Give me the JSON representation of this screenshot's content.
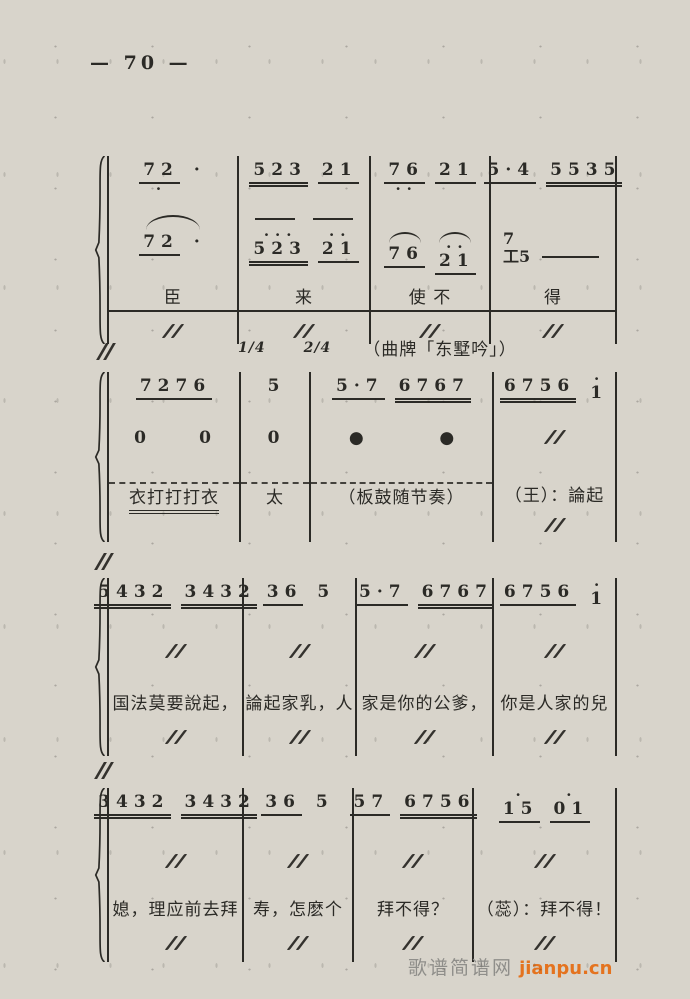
{
  "page": {
    "number": "— 70 —"
  },
  "watermark": {
    "site": "歌谱简谱网",
    "url": "jianpu.cn",
    "url_color": "#e4731f"
  },
  "score": {
    "header": {
      "time_sig_a": "1/4",
      "time_sig_b": "2/4",
      "qupai": "（曲牌「东墅吟」）"
    },
    "systems": [
      {
        "id": 1,
        "top": 156,
        "widths": [
          130,
          132,
          120,
          126
        ],
        "rows": [
          "v1",
          "mid",
          "v2",
          "lyr",
          "sim"
        ],
        "row_heights": [
          56,
          16,
          56,
          34,
          26
        ],
        "measures": [
          {
            "v1": [
              {
                "t": "72",
                "u": 1,
                "db": "·"
              },
              {
                "t": "·"
              }
            ],
            "mid": "arc",
            "v2": [
              {
                "t": "72",
                "u": 1
              },
              {
                "t": "·"
              }
            ],
            "lyr": {
              "t": "臣",
              "ext": true
            },
            "sim": true
          },
          {
            "v1": [
              {
                "t": "523",
                "u": 2
              },
              {
                "t": "21",
                "u": 1
              }
            ],
            "mid": "flat",
            "v2": [
              {
                "t": "523",
                "u": 2,
                "da": "···"
              },
              {
                "t": "21",
                "u": 1,
                "da": "··"
              }
            ],
            "lyr": {
              "t": "来",
              "ext": true
            },
            "sim": true
          },
          {
            "v1": [
              {
                "t": "76",
                "u": 1,
                "db": "··"
              },
              {
                "t": "21",
                "u": 1
              }
            ],
            "mid": "none",
            "v2": [
              {
                "t": "76",
                "u": 1,
                "arc": true
              },
              {
                "t": "21",
                "u": 1,
                "da": "··",
                "arc": true
              }
            ],
            "lyr": {
              "t": "使 不",
              "ext": true
            },
            "sim": true
          },
          {
            "v1": [
              {
                "t": "5·4",
                "u": 1
              },
              {
                "t": "5535",
                "u": 2
              }
            ],
            "mid": "none",
            "v2stack": {
              "top": "7",
              "bottom": "工5"
            },
            "lyr": {
              "t": "得",
              "ext": true
            },
            "sim": true
          }
        ]
      },
      {
        "id": 2,
        "top": 372,
        "widths": [
          132,
          70,
          183,
          123
        ],
        "rows": [
          "v1",
          "v2",
          "lyr"
        ],
        "row_heights": [
          52,
          58,
          60
        ],
        "measures": [
          {
            "v1": [
              {
                "t": "7276",
                "u": 1
              }
            ],
            "v2": [
              {
                "t": "0"
              },
              {
                "t": "0"
              }
            ],
            "lyr": {
              "t": "衣打打打衣",
              "topdash": true,
              "ul": true
            }
          },
          {
            "v1": [
              {
                "t": "5"
              }
            ],
            "v2": [
              {
                "t": "0"
              }
            ],
            "lyr": {
              "t": "太",
              "topdash": true
            }
          },
          {
            "v1": [
              {
                "t": "5·7",
                "u": 1
              },
              {
                "t": "6767",
                "u": 2
              }
            ],
            "v2": [
              {
                "t": "●",
                "big": true
              },
              {
                "t": "●",
                "big": true
              }
            ],
            "lyr": {
              "t": "（板鼓随节奏）",
              "topdash": true
            }
          },
          {
            "v1": [
              {
                "t": "6756",
                "u": 2
              },
              {
                "t": "1",
                "da": "·"
              }
            ],
            "v2": [
              {
                "sim": true
              }
            ],
            "lyr": {
              "t": "（王）：論起",
              "sim_below": true
            }
          }
        ]
      },
      {
        "id": 3,
        "top": 578,
        "widths": [
          135,
          113,
          137,
          123
        ],
        "rows": [
          "v1",
          "sim",
          "lyr",
          "sim2"
        ],
        "row_heights": [
          60,
          52,
          34,
          32
        ],
        "measures": [
          {
            "v1": [
              {
                "t": "5432",
                "u": 2
              },
              {
                "t": "3432",
                "u": 2
              }
            ],
            "sim": true,
            "lyr": {
              "t": "国法莫要說起，"
            },
            "sim2": true
          },
          {
            "v1": [
              {
                "t": "36",
                "u": 1
              },
              {
                "t": "5"
              }
            ],
            "sim": true,
            "lyr": {
              "t": "論起家乳，人"
            },
            "sim2": true
          },
          {
            "v1": [
              {
                "t": "5·7",
                "u": 1
              },
              {
                "t": "6767",
                "u": 2
              }
            ],
            "sim": true,
            "lyr": {
              "t": "家是你的公爹，"
            },
            "sim2": true
          },
          {
            "v1": [
              {
                "t": "6756",
                "u": 1
              },
              {
                "t": "1",
                "da": "·"
              }
            ],
            "sim": true,
            "lyr": {
              "t": "你是人家的兒"
            },
            "sim2": true
          }
        ]
      },
      {
        "id": 4,
        "top": 788,
        "widths": [
          135,
          110,
          120,
          143
        ],
        "rows": [
          "v1",
          "sim",
          "lyr",
          "sim2"
        ],
        "row_heights": [
          60,
          48,
          34,
          32
        ],
        "measures": [
          {
            "v1": [
              {
                "t": "3432",
                "u": 2
              },
              {
                "t": "3432",
                "u": 2
              }
            ],
            "sim": true,
            "lyr": {
              "t": "媳，理应前去拜"
            },
            "sim2": true
          },
          {
            "v1": [
              {
                "t": "36",
                "u": 1
              },
              {
                "t": "5"
              }
            ],
            "sim": true,
            "lyr": {
              "t": "寿，怎麽个"
            },
            "sim2": true
          },
          {
            "v1": [
              {
                "t": "57",
                "u": 1
              },
              {
                "t": "6756",
                "u": 2
              }
            ],
            "sim": true,
            "lyr": {
              "t": "拜不得？"
            },
            "sim2": true
          },
          {
            "v1": [
              {
                "t": "15",
                "u": 1,
                "da": "·"
              },
              {
                "t": "01",
                "u": 1,
                "da": "·"
              }
            ],
            "sim": true,
            "lyr": {
              "t": "（蕊）：拜不得！"
            },
            "sim2": true
          }
        ]
      }
    ]
  }
}
